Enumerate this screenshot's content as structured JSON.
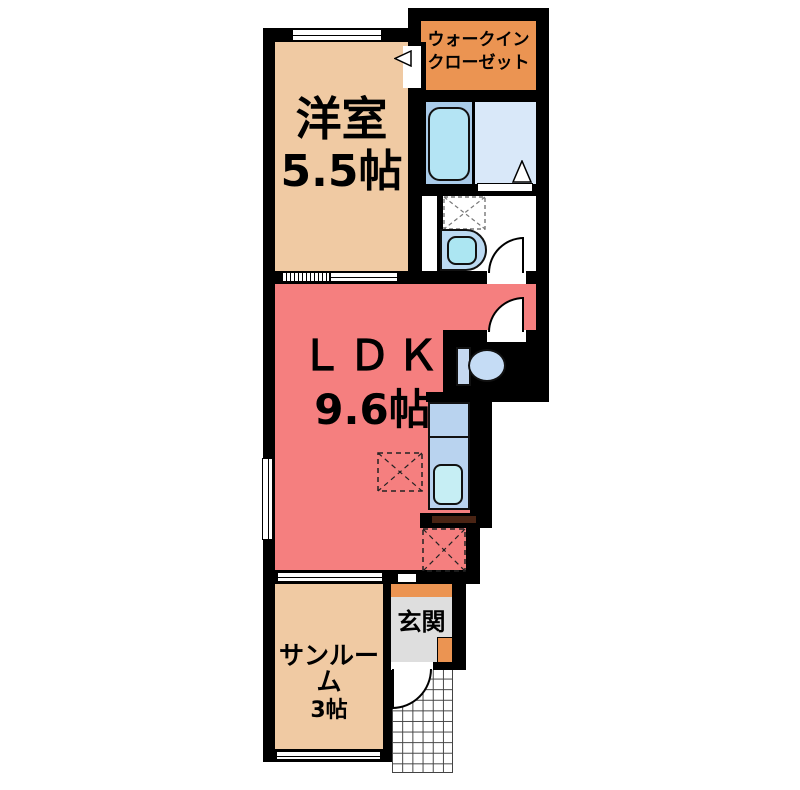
{
  "plan_title": "1LDK apartment floor plan",
  "rooms": {
    "western": {
      "name": "洋室",
      "size": "5.5帖"
    },
    "ldk": {
      "name": "ＬＤＫ",
      "size": "9.6帖"
    },
    "sunroom": {
      "name": "サンルーム",
      "size": "3帖"
    },
    "entrance": {
      "name": "玄関"
    },
    "closet": {
      "line1": "ウォークイン",
      "line2": "クローゼット"
    }
  },
  "colors": {
    "room_tan": "#F0CAA3",
    "ldk_salmon": "#F57F7F",
    "accent_orange": "#EB9452",
    "bath_blue": "#A9CBE9",
    "light_blue_floor": "#D9E8F9",
    "kitchen_counter_blue": "#B9D3EF",
    "fixture_cyan": "#B4E4F4",
    "entrance_gray": "#DEDEDE",
    "wall": "#000000"
  }
}
